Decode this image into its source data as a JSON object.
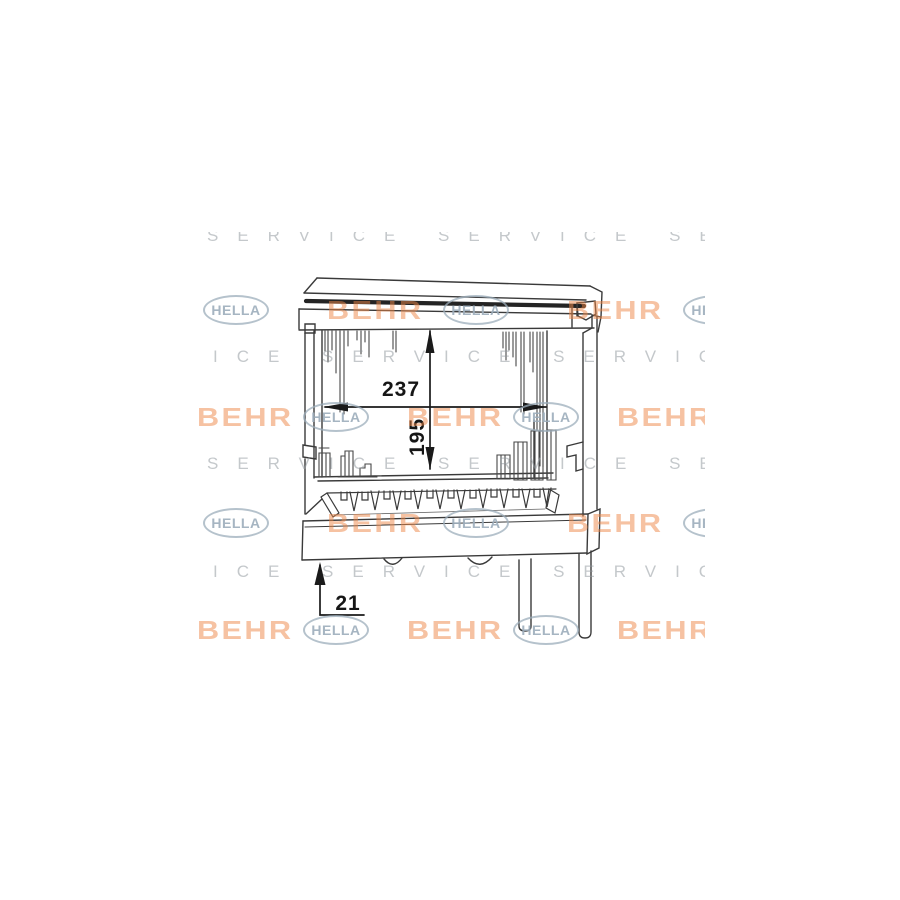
{
  "diagram": {
    "title": "heater-core-technical-drawing",
    "dimensions": {
      "width_label": "237",
      "height_label": "195",
      "depth_label": "21"
    },
    "line_color": "#3a3a3a",
    "dimension_color": "#1a1a1a"
  },
  "watermark": {
    "hella": "HELLA",
    "behr": "BEHR",
    "service": "SERVICE SERVICE SERVICE",
    "colors": {
      "behr_orange": "#ee8646",
      "hella_blue_gray": "#9cadbb",
      "service_gray": "#949aa0"
    }
  }
}
